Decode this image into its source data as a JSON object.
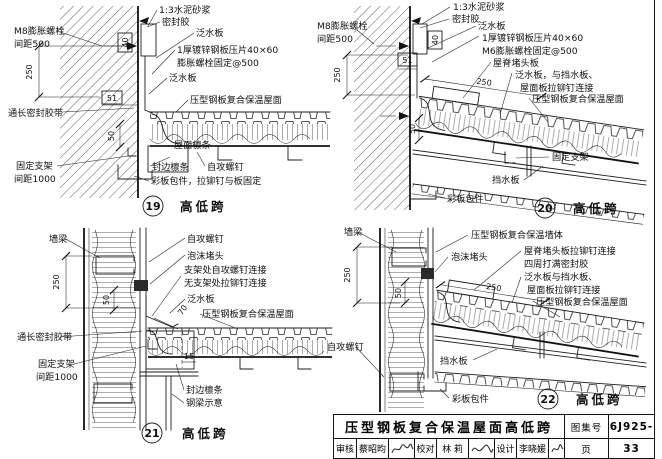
{
  "d19": {
    "num": "19",
    "cap": "高低跨",
    "mortar": "1:3水泥砂浆",
    "sealant": "密封胶",
    "flashing1": "泛水板",
    "press": "1厚镀锌钢板压片40×60",
    "bolt_fix": "膨胀螺栓固定@500",
    "flashing2": "泛水板",
    "roof": "压型钢板复合保温屋面",
    "anchor1": "M8膨胀螺栓",
    "anchor2": "间距500",
    "tape": "通长密封胶带",
    "bracket1": "固定支架",
    "bracket2": "间距1000",
    "purlin": "屋面檩条",
    "edge_purlin": "封边檩条",
    "screw": "自攻螺钉",
    "wrap": "彩板包件，拉铆钉与板固定",
    "dim250": "250",
    "dim51": "51",
    "dim40": "40",
    "dim50": "50"
  },
  "d20": {
    "num": "20",
    "cap": "高低跨",
    "anchor1": "M8膨胀螺栓",
    "anchor2": "间距500",
    "mortar": "1:3水泥砂浆",
    "sealant": "密封胶",
    "flashing1": "泛水板",
    "press": "1厚镀锌钢板压片40×60",
    "bolt_fix": "M6膨胀螺栓固定@500",
    "ridge": "屋脊堵头板",
    "flash_a": "泛水板，与挡水板、",
    "flash_b": "屋面板拉铆钉连接",
    "roof": "压型钢板复合保温屋面",
    "bracket": "固定支架",
    "water": "挡水板",
    "wrap": "彩板包件",
    "dim250": "250",
    "dim51": "51",
    "dim40": "40",
    "dim50": "50",
    "dim250d": "250"
  },
  "d21": {
    "num": "21",
    "cap": "高低跨",
    "girt": "墙梁",
    "screw": "自攻螺钉",
    "foam": "泡沫堵头",
    "conn1": "支架处自攻螺钉连接",
    "conn2": "无支架处拉铆钉连接",
    "flashing": "泛水板",
    "roof": "压型钢板复合保温屋面",
    "tape": "通长密封胶带",
    "bracket1": "固定支架",
    "bracket2": "间距1000",
    "edge_purlin": "封边檩条",
    "beam": "钢梁示意",
    "dim250": "250",
    "dim50": "50",
    "dim70": "70",
    "dim15": "15"
  },
  "d22": {
    "num": "22",
    "cap": "高低跨",
    "girt": "墙梁",
    "wall": "压型钢板复合保温墙体",
    "foam": "泡沫堵头",
    "ridge1": "屋脊堵头板拉铆钉连接",
    "ridge2": "四周打满密封胶",
    "flash_a": "泛水板与挡水板、",
    "flash_b": "屋面板拉铆钉连接",
    "roof": "压型钢板复合保温屋面",
    "screw": "自攻螺钉",
    "water": "挡水板",
    "wrap": "彩板包件",
    "dim250": "250",
    "dim50": "50",
    "dim250d": "250"
  },
  "titleblock": {
    "title": "压型钢板复合保温屋面高低跨",
    "atlas_label": "图集号",
    "atlas_no": "06J925-2",
    "page_label": "页",
    "page_no": "33",
    "review_label": "审核",
    "reviewer": "蔡昭昀",
    "check_label": "校对",
    "checker": "林  莉",
    "design_label": "设计",
    "designer": "李晓媛"
  }
}
